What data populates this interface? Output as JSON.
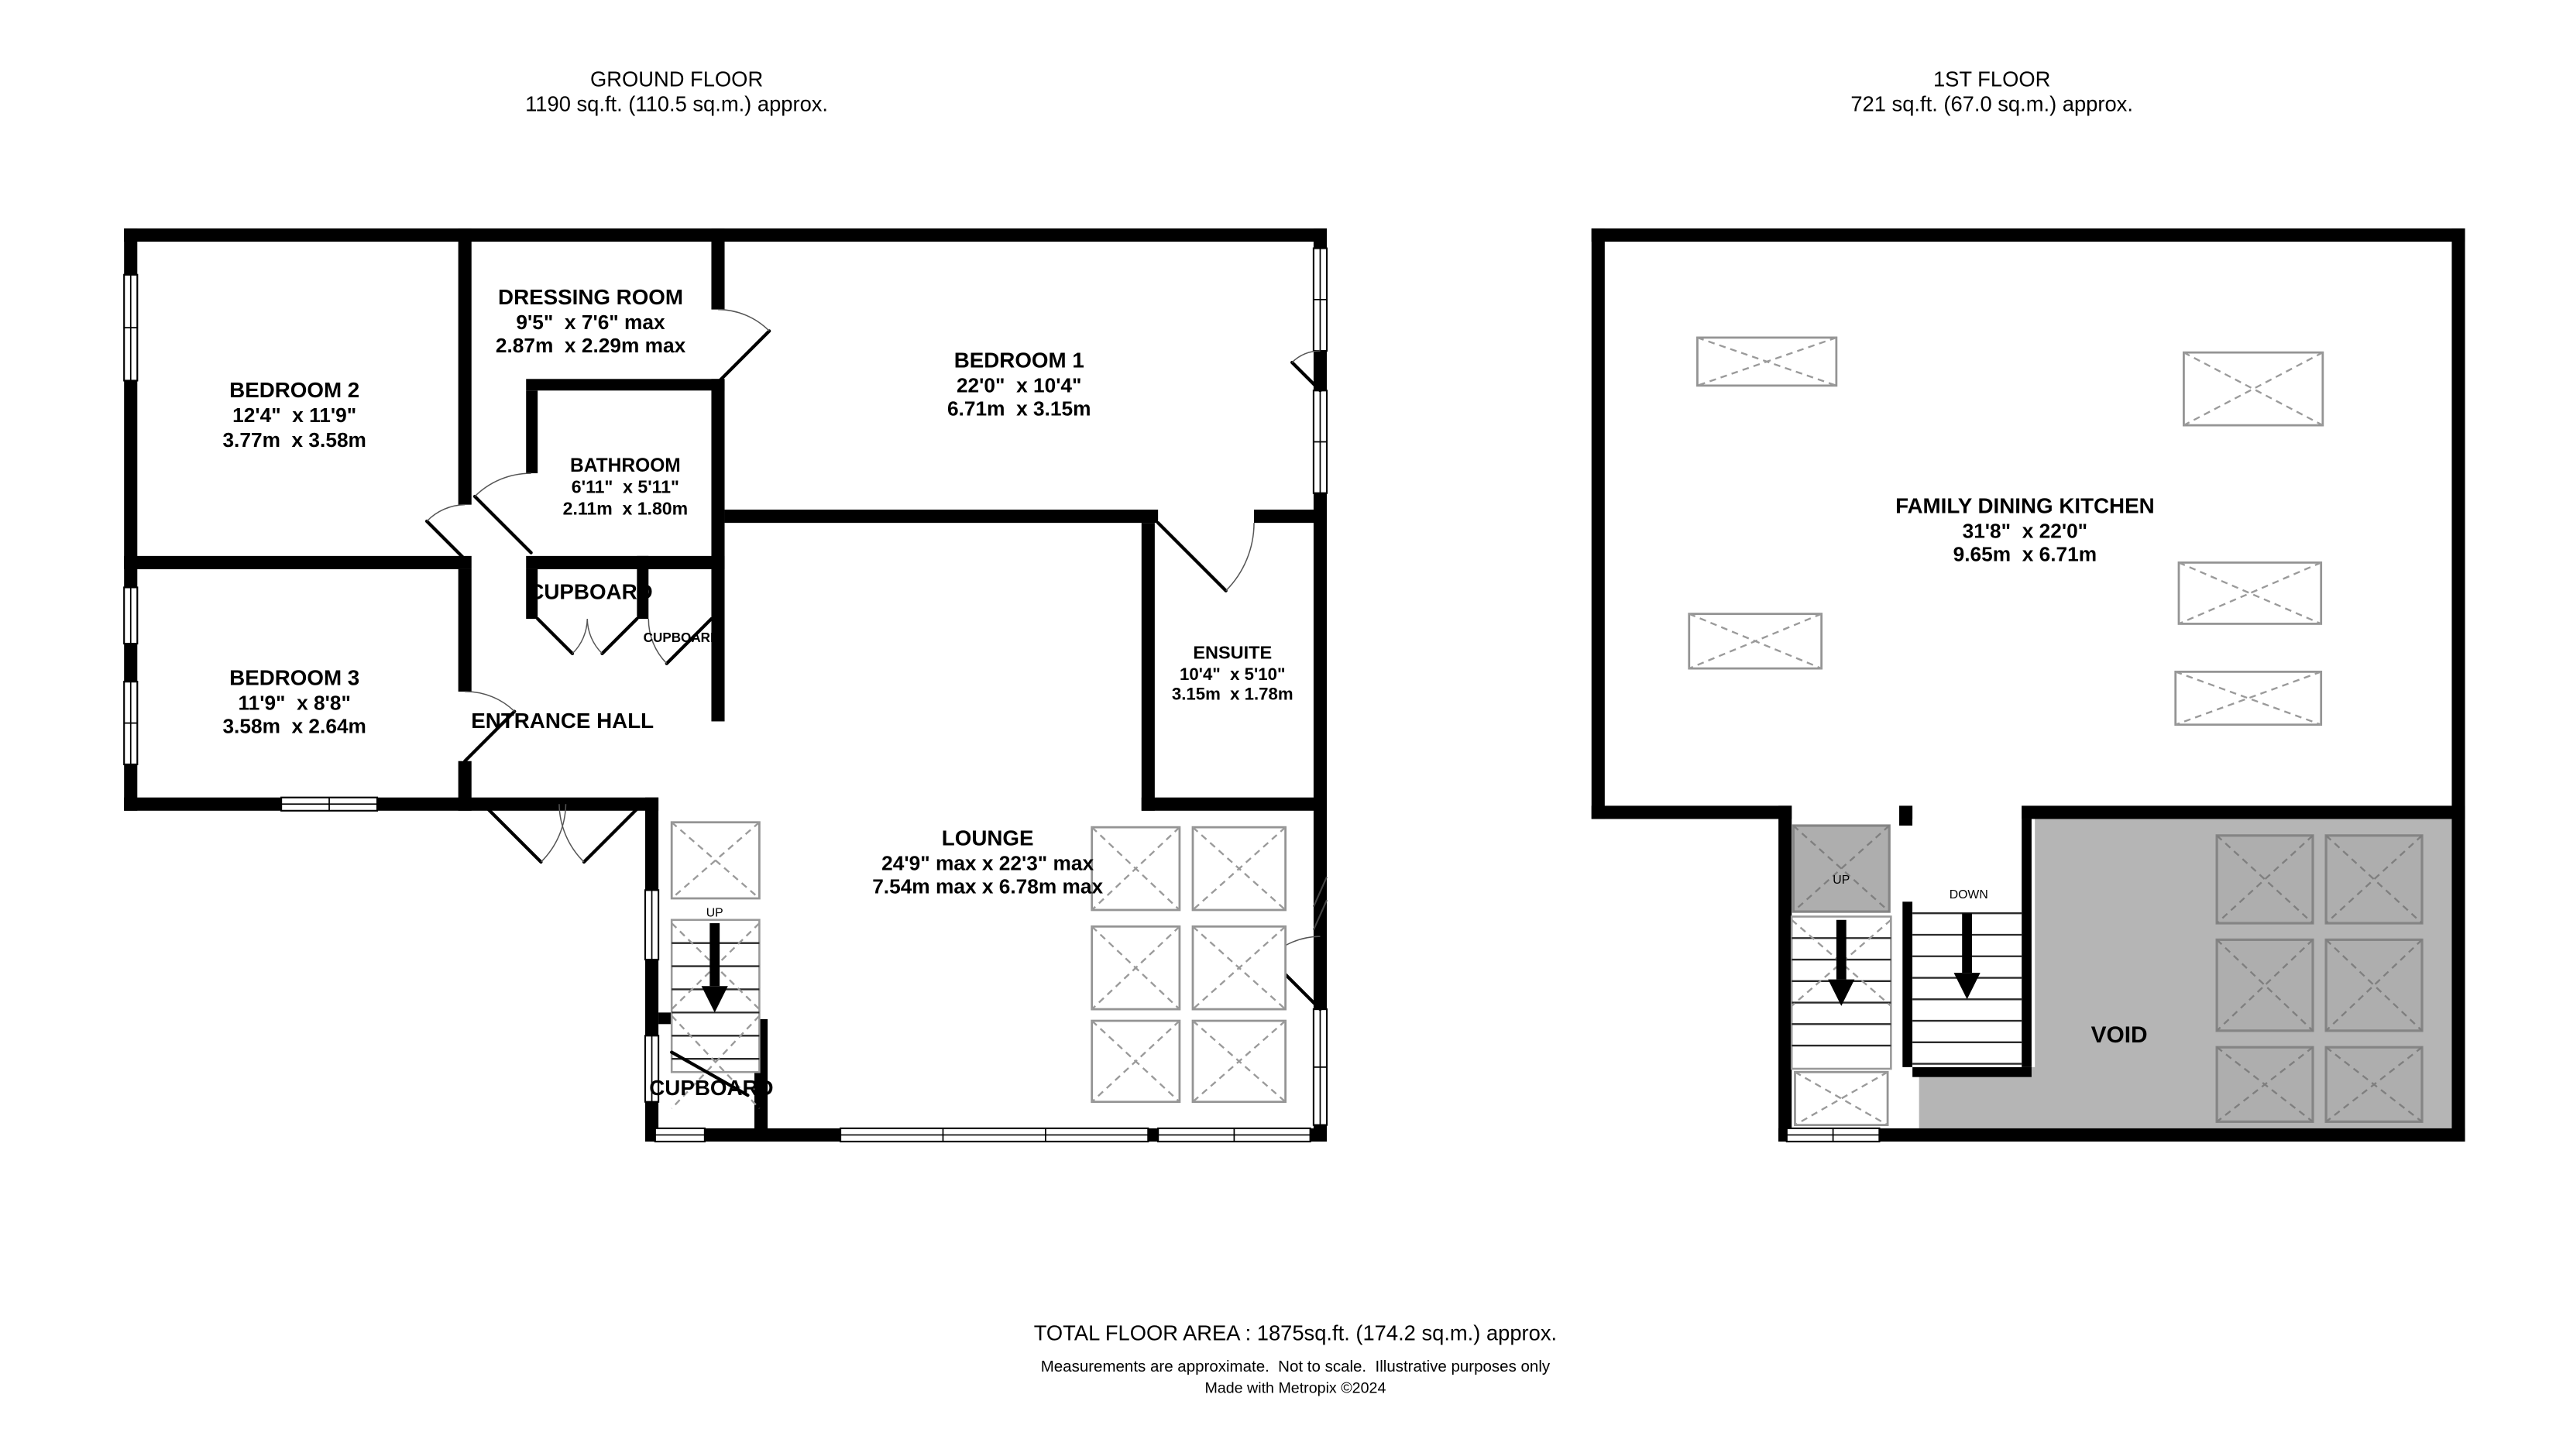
{
  "ground_floor": {
    "title": "GROUND FLOOR",
    "area": "1190 sq.ft. (110.5 sq.m.) approx.",
    "rooms": {
      "bedroom2": {
        "name": "BEDROOM 2",
        "imperial": "12'4\"  x 11'9\"",
        "metric": "3.77m  x 3.58m"
      },
      "bedroom3": {
        "name": "BEDROOM 3",
        "imperial": "11'9\"  x 8'8\"",
        "metric": "3.58m  x 2.64m"
      },
      "dressing_room": {
        "name": "DRESSING ROOM",
        "imperial": "9'5\"  x 7'6\" max",
        "metric": "2.87m  x 2.29m max"
      },
      "bedroom1": {
        "name": "BEDROOM 1",
        "imperial": "22'0\"  x 10'4\"",
        "metric": "6.71m  x 3.15m"
      },
      "bathroom": {
        "name": "BATHROOM",
        "imperial": "6'11\"  x 5'11\"",
        "metric": "2.11m  x 1.80m"
      },
      "ensuite": {
        "name": "ENSUITE",
        "imperial": "10'4\"  x 5'10\"",
        "metric": "3.15m  x 1.78m"
      },
      "lounge": {
        "name": "LOUNGE",
        "imperial": "24'9\" max x 22'3\" max",
        "metric": "7.54m max x 6.78m max"
      },
      "entrance_hall": {
        "name": "ENTRANCE HALL"
      },
      "cupboard_hall": {
        "name": "CUPBOARD"
      },
      "cupboard_small": {
        "name": "CUPBOARD"
      },
      "cupboard_lounge": {
        "name": "CUPBOARD"
      },
      "stairs": {
        "up_label": "UP"
      }
    }
  },
  "first_floor": {
    "title": "1ST FLOOR",
    "area": "721 sq.ft. (67.0 sq.m.) approx.",
    "rooms": {
      "family_dining_kitchen": {
        "name": "FAMILY DINING KITCHEN",
        "imperial": "31'8\"  x 22'0\"",
        "metric": "9.65m  x 6.71m"
      },
      "void": {
        "name": "VOID"
      },
      "stairs": {
        "up_label": "UP",
        "down_label": "DOWN"
      }
    }
  },
  "footer": {
    "total_area": "TOTAL FLOOR AREA : 1875sq.ft. (174.2 sq.m.) approx.",
    "disclaimer": "Measurements are approximate.  Not to scale.  Illustrative purposes only",
    "credit": "Made with Metropix ©2024"
  },
  "colors": {
    "wall": "#000000",
    "void_fill": "#b5b5b5",
    "skylight_stroke": "#949494"
  }
}
